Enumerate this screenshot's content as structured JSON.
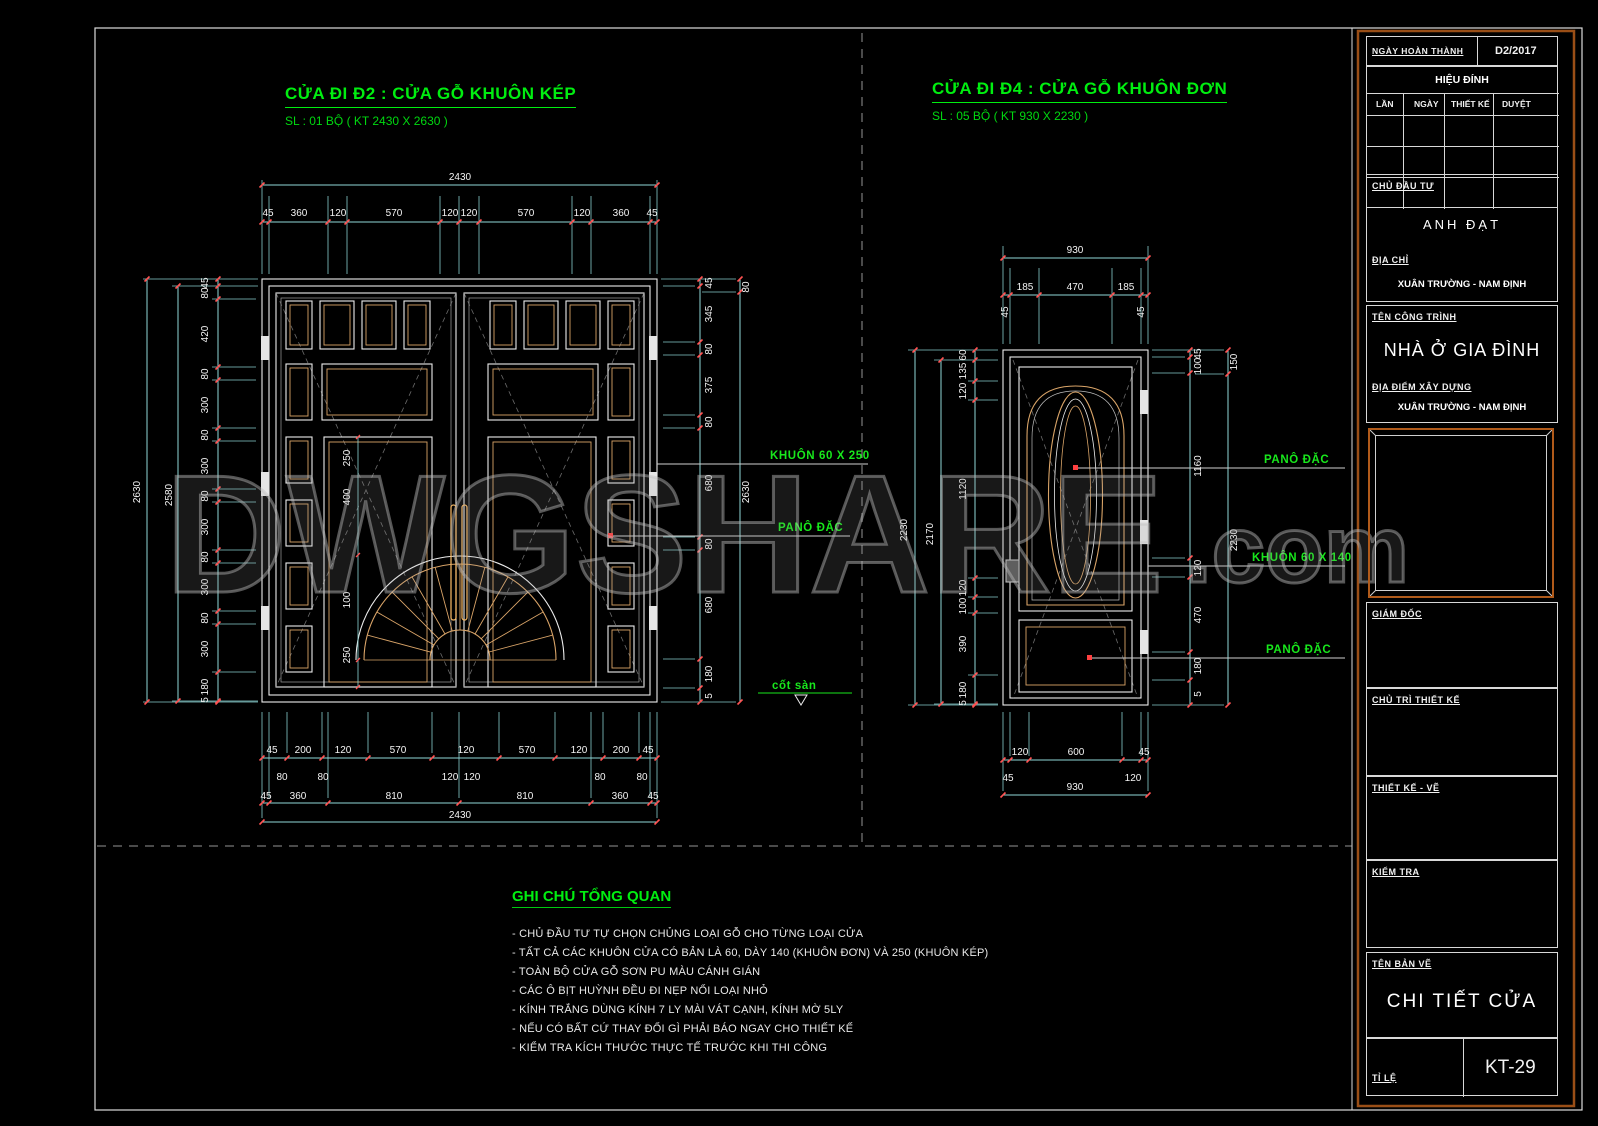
{
  "colors": {
    "accent_green": "#00ee10",
    "dim_cyan": "#8fd8d8",
    "tick_red": "#ff5252",
    "wood_tan": "#d9a468",
    "border_orange": "#9a4e16"
  },
  "titles": {
    "left": {
      "heading": "CỬA ĐI Đ2 : CỬA GỖ KHUÔN KÉP",
      "subtitle": "SL : 01 BỘ ( KT 2430 X 2630 )"
    },
    "right": {
      "heading": "CỬA ĐI Đ4 : CỬA GỖ KHUÔN ĐƠN",
      "subtitle": "SL : 05 BỘ ( KT 930 X 2230 )"
    }
  },
  "callouts": {
    "khuon_kep": "KHUÔN 60 X 250",
    "pano_left": "PANÔ ĐẶC",
    "cot_san": "cốt sàn",
    "pano_r1": "PANÔ ĐẶC",
    "khuon_don": "KHUÔN 60 X 140",
    "pano_r2": "PANÔ ĐẶC"
  },
  "watermark": {
    "main": "DWGSHARE",
    "suffix": ".com"
  },
  "left_door": {
    "width_total": "2430",
    "top_chain": [
      "45",
      "360",
      "120",
      "570",
      "120",
      "120",
      "570",
      "120",
      "360",
      "45"
    ],
    "left_outer": [
      "2630",
      "2580"
    ],
    "left_chain": [
      "45",
      "80",
      "420",
      "80",
      "300",
      "80",
      "300",
      "80",
      "300",
      "80",
      "300",
      "80",
      "300",
      "180",
      "5"
    ],
    "interior_chain": [
      "250",
      "400",
      "100",
      "250"
    ],
    "right_chain": [
      "45",
      "345",
      "80",
      "375",
      "80",
      "680",
      "80",
      "680",
      "180",
      "5"
    ],
    "right_outer": [
      "80",
      "2630"
    ],
    "bottom_row1": [
      "45",
      "200",
      "120",
      "570",
      "120",
      "570",
      "120",
      "200",
      "45"
    ],
    "bottom_row2": [
      "80",
      "80",
      "120",
      "120",
      "80",
      "80"
    ],
    "bottom_row3": [
      "45",
      "360",
      "810",
      "810",
      "360",
      "45"
    ],
    "bottom_total": "2430"
  },
  "right_door": {
    "width_total": "930",
    "top_chain": [
      "185",
      "470",
      "185"
    ],
    "top_side": [
      "45",
      "45"
    ],
    "left_outer": [
      "2230",
      "2170"
    ],
    "left_chain": [
      "60",
      "135",
      "120",
      "1120",
      "120",
      "100",
      "390",
      "180",
      "5"
    ],
    "right_chain": [
      "45",
      "100",
      "1160",
      "120",
      "470",
      "180",
      "5"
    ],
    "right_outer": [
      "150",
      "2230"
    ],
    "bottom_row1": [
      "120",
      "600",
      "45"
    ],
    "bottom_row2": [
      "45",
      "120"
    ],
    "bottom_total": "930"
  },
  "notes": {
    "heading": "GHI CHÚ TỔNG QUAN",
    "items": [
      "- CHỦ ĐẦU TƯ TỰ CHỌN CHỦNG LOẠI GỖ CHO TỪNG LOẠI CỬA",
      "- TẤT CẢ CÁC KHUÔN CỬA CÓ BẢN LÀ 60, DÀY 140 (KHUÔN ĐƠN) VÀ 250 (KHUÔN KÉP)",
      "- TOÀN BỘ CỬA GỖ SƠN PU MÀU CÁNH GIÁN",
      "- CÁC Ô BỊT HUỲNH ĐỀU ĐI NẸP NỔI LOẠI NHỎ",
      "- KÍNH TRẮNG DÙNG KÍNH 7 LY MÀI VÁT CẠNH, KÍNH MỜ 5LY",
      "- NẾU CÓ BẤT CỨ THAY ĐỔI GÌ PHẢI BÁO NGAY CHO THIẾT KẾ",
      "- KIỂM TRA KÍCH THƯỚC THỰC TẾ TRƯỚC KHI THI CÔNG"
    ]
  },
  "titleblock": {
    "date_label": "NGÀY HOÀN THÀNH",
    "date_value": "D2/2017",
    "revision_title": "HIỆU ĐÍNH",
    "revision_cols": [
      "LẦN",
      "NGÀY",
      "THIẾT KẾ",
      "DUYỆT"
    ],
    "client_label": "CHỦ ĐẦU TƯ",
    "client_value": "ANH ĐẠT",
    "address_label": "ĐỊA CHỈ",
    "address_value": "XUÂN TRƯỜNG - NAM ĐỊNH",
    "project_label": "TÊN CÔNG TRÌNH",
    "project_value": "NHÀ Ở GIA ĐÌNH",
    "location_label": "ĐỊA ĐIỂM XÂY DỰNG",
    "location_value": "XUÂN TRƯỜNG - NAM ĐỊNH",
    "director_label": "GIÁM ĐỐC",
    "lead_label": "CHỦ TRÌ THIẾT KẾ",
    "designer_label": "THIẾT KẾ - VẼ",
    "checker_label": "KIỂM TRA",
    "drawing_name_label": "TÊN BẢN VẼ",
    "drawing_name": "CHI TIẾT CỬA",
    "scale_label": "TỈ LỆ",
    "sheet_number": "KT-29"
  }
}
